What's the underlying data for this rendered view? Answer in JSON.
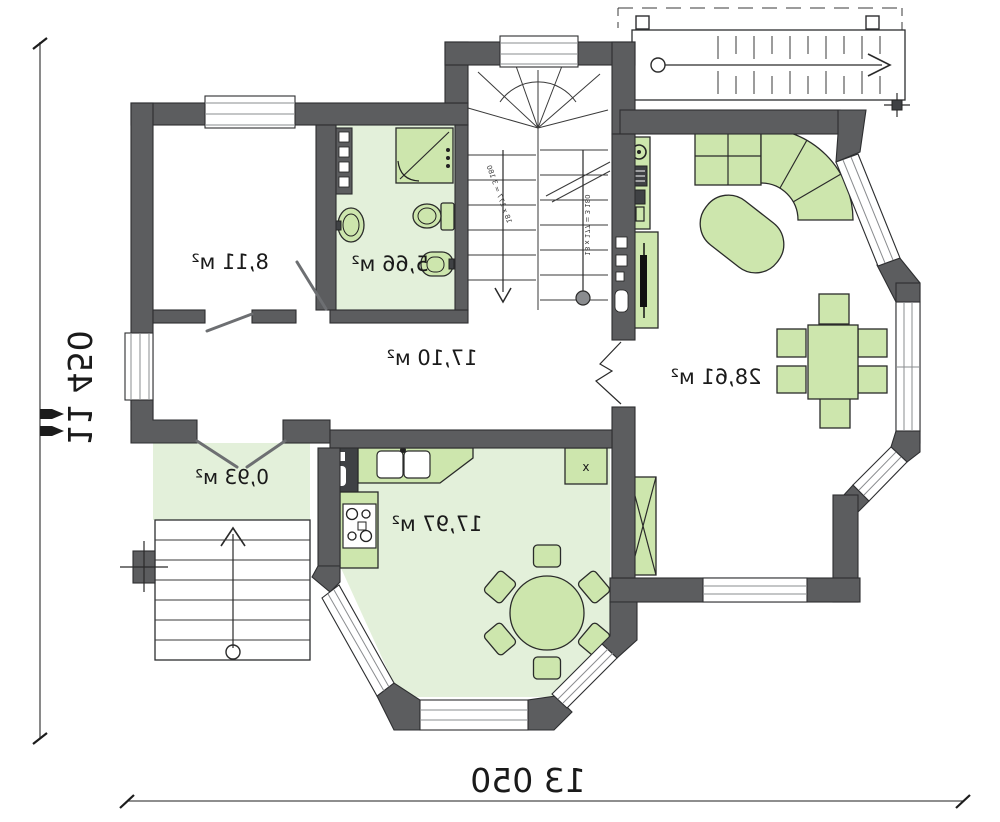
{
  "drawing": {
    "type_label": "mirrored floor plan",
    "rooms": [
      {
        "id": "bedroom",
        "area_label": "8,11 м²"
      },
      {
        "id": "bathroom",
        "area_label": "5,66 м²"
      },
      {
        "id": "hallway",
        "area_label": "17,10 м²"
      },
      {
        "id": "living-room",
        "area_label": "28,61 м²"
      },
      {
        "id": "entry-porch",
        "area_label": "0,93 м²"
      },
      {
        "id": "kitchen",
        "area_label": "17,97 м²"
      }
    ],
    "dimensions": {
      "overall_width": "13 050",
      "overall_height": "11 450"
    },
    "stair_note": "18 x 177 = 3 180",
    "fridge_mark": "x",
    "colors": {
      "wall": "#5c5d5f",
      "outline": "#2d2e30",
      "floor_green": "#e3f0da",
      "furniture_green": "#cde6ad",
      "window_frame": "#8a8c8f"
    }
  }
}
